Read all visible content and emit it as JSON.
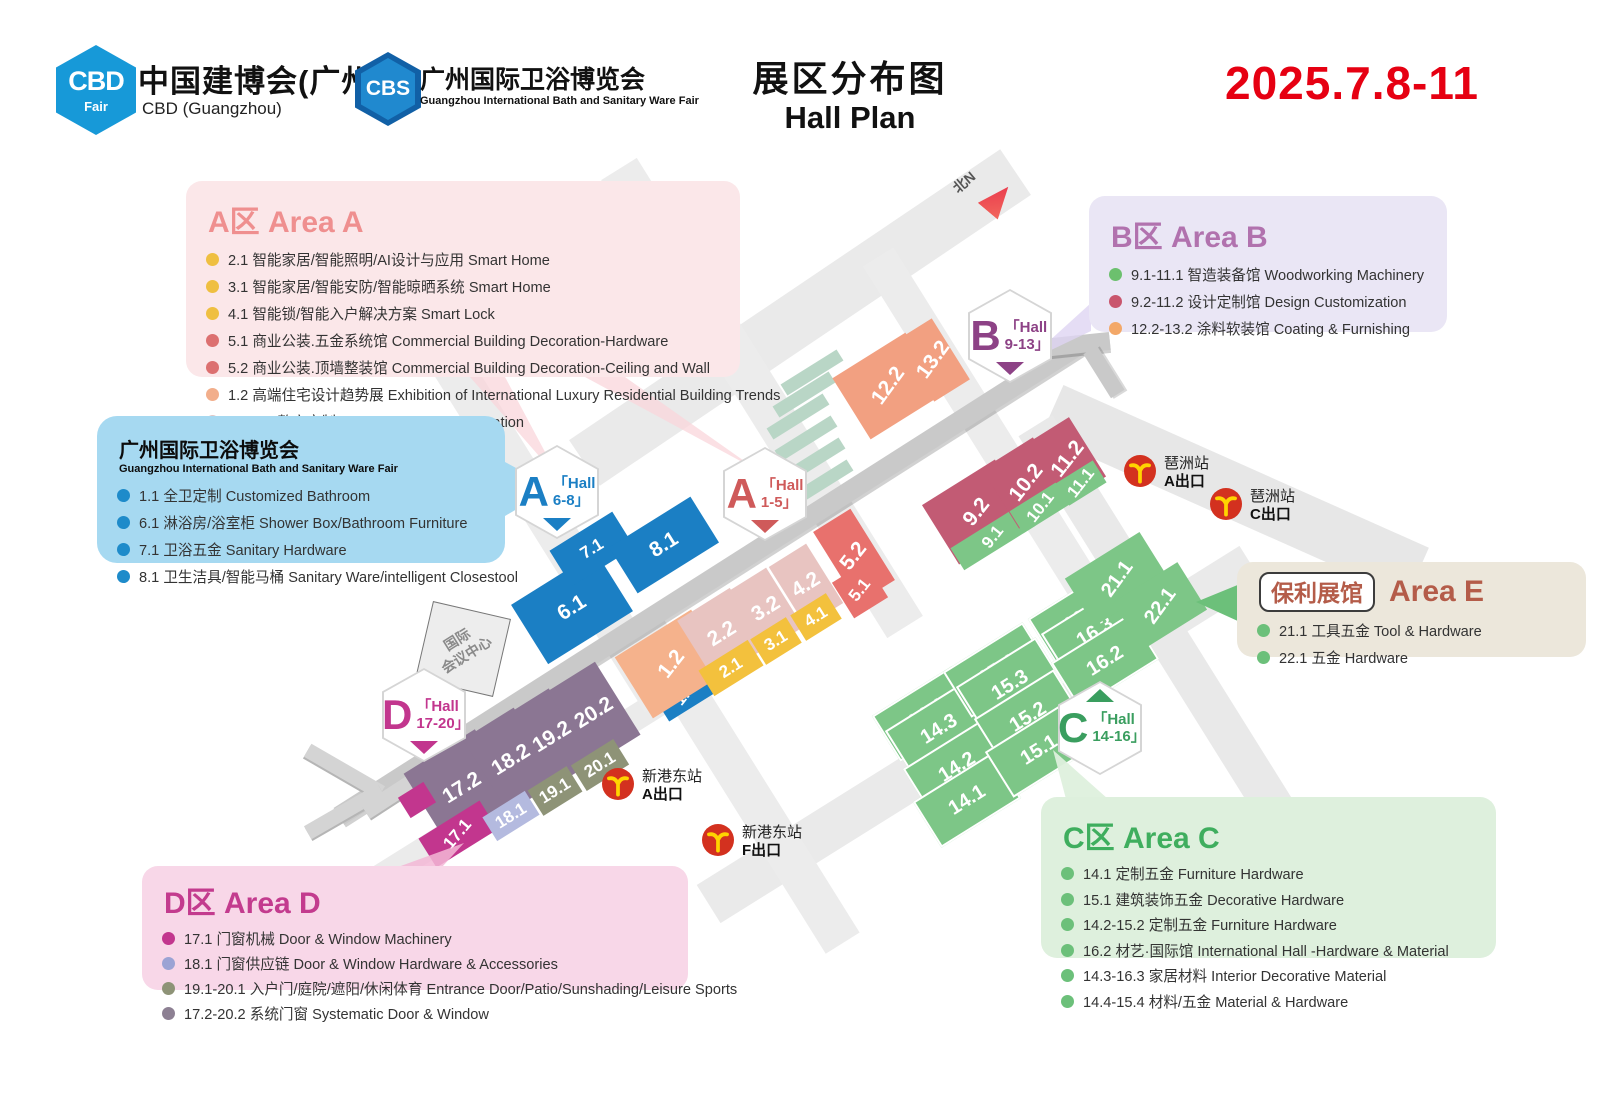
{
  "header": {
    "logo_cbd": {
      "hex": "CBD",
      "hex_sub": "Fair",
      "title": "中国建博会(广州)",
      "subtitle": "CBD (Guangzhou)"
    },
    "logo_cbs": {
      "hex": "CBS",
      "title": "广州国际卫浴博览会",
      "subtitle": "Guangzhou International Bath and Sanitary Ware Fair"
    },
    "title_cn": "展区分布图",
    "title_en": "Hall Plan",
    "date": "2025.7.8-11"
  },
  "legends": {
    "area_a": {
      "title": "A区 Area A",
      "color": "#ef8f8f",
      "bg": "#fbe7e9",
      "items": [
        {
          "dot": "#efbf41",
          "text": "2.1 智能家居/智能照明/AI设计与应用 Smart Home"
        },
        {
          "dot": "#efbf41",
          "text": "3.1 智能家居/智能安防/智能晾晒系统 Smart Home"
        },
        {
          "dot": "#efbf41",
          "text": "4.1 智能锁/智能入户解决方案 Smart Lock"
        },
        {
          "dot": "#dc7070",
          "text": "5.1 商业公装.五金系统馆 Commercial Building Decoration-Hardware"
        },
        {
          "dot": "#dc7070",
          "text": "5.2 商业公装.顶墙整装馆 Commercial Building Decoration-Ceiling and Wall"
        },
        {
          "dot": "#f2ae8b",
          "text": "1.2 高端住宅设计趋势展 Exhibition of International Luxury Residential Building Trends"
        },
        {
          "dot": "#dfc6c6",
          "text": "2.2-4.2 整家定制 Whole House Customization"
        }
      ]
    },
    "bath_fair": {
      "title": "广州国际卫浴博览会",
      "subtitle": "Guangzhou International Bath and Sanitary Ware Fair",
      "bg": "#a6d9f1",
      "items": [
        {
          "dot": "#1e8bca",
          "text": "1.1 全卫定制 Customized Bathroom"
        },
        {
          "dot": "#1e8bca",
          "text": "6.1 淋浴房/浴室柜 Shower Box/Bathroom Furniture"
        },
        {
          "dot": "#1e8bca",
          "text": "7.1 卫浴五金 Sanitary Hardware"
        },
        {
          "dot": "#1e8bca",
          "text": "8.1 卫生洁具/智能马桶 Sanitary Ware/intelligent Closestool"
        }
      ]
    },
    "area_b": {
      "title": "B区 Area B",
      "color": "#b172ae",
      "bg": "#eae6f5",
      "items": [
        {
          "dot": "#6cc06e",
          "text": "9.1-11.1 智造装备馆 Woodworking Machinery"
        },
        {
          "dot": "#c9556d",
          "text": "9.2-11.2 设计定制馆 Design Customization"
        },
        {
          "dot": "#f3a868",
          "text": "12.2-13.2 涂料软装馆 Coating & Furnishing"
        }
      ]
    },
    "area_e": {
      "pill": "保利展馆",
      "title": "Area E",
      "color": "#b45c49",
      "bg": "#ece7db",
      "items": [
        {
          "dot": "#6cc07a",
          "text": "21.1 工具五金 Tool & Hardware"
        },
        {
          "dot": "#6cc07a",
          "text": "22.1 五金 Hardware"
        }
      ]
    },
    "area_c": {
      "title": "C区 Area C",
      "color": "#3fae5e",
      "bg": "#def0dd",
      "items": [
        {
          "dot": "#6cc07a",
          "text": "14.1 定制五金 Furniture Hardware"
        },
        {
          "dot": "#6cc07a",
          "text": "15.1 建筑装饰五金 Decorative Hardware"
        },
        {
          "dot": "#6cc07a",
          "text": "14.2-15.2 定制五金 Furniture Hardware"
        },
        {
          "dot": "#6cc07a",
          "text": "16.2 材艺·国际馆 International Hall -Hardware & Material"
        },
        {
          "dot": "#6cc07a",
          "text": "14.3-16.3 家居材料 Interior Decorative Material"
        },
        {
          "dot": "#6cc07a",
          "text": "14.4-15.4 材料/五金 Material & Hardware"
        }
      ]
    },
    "area_d": {
      "title": "D区 Area D",
      "color": "#c33b8e",
      "bg": "#f8d7e8",
      "items": [
        {
          "dot": "#c2368e",
          "text": "17.1 门窗机械  Door & Window Machinery"
        },
        {
          "dot": "#9ba3d4",
          "text": "18.1 门窗供应链  Door & Window Hardware & Accessories"
        },
        {
          "dot": "#8e9377",
          "text": "19.1-20.1 入户门/庭院/遮阳/休闲体育 Entrance Door/Patio/Sunshading/Leisure Sports"
        },
        {
          "dot": "#8d8093",
          "text": "17.2-20.2 系统门窗 Systematic Door & Window"
        }
      ]
    }
  },
  "map": {
    "north_label": "北N",
    "convention_center_line1": "国际",
    "convention_center_line2": "会议中心",
    "badges": [
      {
        "letter": "A",
        "line1": "「Hall",
        "line2": "6-8」",
        "color": "#1b7fc4",
        "x": 557,
        "y": 492,
        "tri": "bottom"
      },
      {
        "letter": "A",
        "line1": "「Hall",
        "line2": "1-5」",
        "color": "#cf5a5a",
        "x": 765,
        "y": 494,
        "tri": "bottom"
      },
      {
        "letter": "B",
        "line1": "「Hall",
        "line2": "9-13」",
        "color": "#8d4286",
        "x": 1010,
        "y": 336,
        "tri": "bottom"
      },
      {
        "letter": "C",
        "line1": "「Hall",
        "line2": "14-16」",
        "color": "#3a9e5f",
        "x": 1100,
        "y": 728,
        "tri": "top"
      },
      {
        "letter": "D",
        "line1": "「Hall",
        "line2": "17-20」",
        "color": "#c2368e",
        "x": 424,
        "y": 715,
        "tri": "bottom"
      }
    ],
    "stations": [
      {
        "name": "琶洲站",
        "exit": "A出口",
        "x": 1124,
        "y": 455
      },
      {
        "name": "琶洲站",
        "exit": "C出口",
        "x": 1210,
        "y": 488
      },
      {
        "name": "新港东站",
        "exit": "A出口",
        "x": 602,
        "y": 768
      },
      {
        "name": "新港东站",
        "exit": "F出口",
        "x": 702,
        "y": 824
      }
    ],
    "halls": [
      {
        "label": "6.1",
        "x": 572,
        "y": 608,
        "w": 100,
        "h": 70,
        "color": "#1b7fc4",
        "fs": 21
      },
      {
        "label": "7.1",
        "x": 592,
        "y": 549,
        "w": 74,
        "h": 42,
        "color": "#1b7fc4",
        "fs": 17
      },
      {
        "label": "8.1",
        "x": 664,
        "y": 545,
        "w": 96,
        "h": 54,
        "color": "#1b7fc4",
        "fs": 21
      },
      {
        "label": "1.1",
        "x": 685,
        "y": 694,
        "w": 56,
        "h": 30,
        "color": "#1b7fc4",
        "fs": 17,
        "tilt": -20
      },
      {
        "label": "1.2",
        "x": 672,
        "y": 664,
        "w": 90,
        "h": 72,
        "color": "#f5b28c",
        "fs": 21,
        "tilt": -20
      },
      {
        "label": "2.2",
        "x": 722,
        "y": 634,
        "w": 62,
        "h": 70,
        "color": "#e8c4c1",
        "fs": 21
      },
      {
        "label": "3.2",
        "x": 766,
        "y": 609,
        "w": 44,
        "h": 70,
        "color": "#e8c4c1",
        "fs": 21
      },
      {
        "label": "4.2",
        "x": 806,
        "y": 585,
        "w": 44,
        "h": 70,
        "color": "#e8c4c1",
        "fs": 21
      },
      {
        "label": "2.1",
        "x": 731,
        "y": 668,
        "w": 58,
        "h": 30,
        "color": "#f3c13d",
        "fs": 17
      },
      {
        "label": "3.1",
        "x": 776,
        "y": 641,
        "w": 42,
        "h": 30,
        "color": "#f3c13d",
        "fs": 17
      },
      {
        "label": "4.1",
        "x": 816,
        "y": 617,
        "w": 42,
        "h": 30,
        "color": "#f3c13d",
        "fs": 17
      },
      {
        "label": "5.2",
        "x": 854,
        "y": 556,
        "w": 44,
        "h": 84,
        "color": "#e8716d",
        "fs": 21,
        "tilt": -20
      },
      {
        "label": "5.1",
        "x": 860,
        "y": 590,
        "w": 40,
        "h": 42,
        "color": "#e8716d",
        "fs": 17,
        "tilt": -20
      },
      {
        "label": "12.2",
        "x": 888,
        "y": 386,
        "w": 86,
        "h": 72,
        "color": "#f2a081",
        "fs": 21,
        "tilt": -22
      },
      {
        "label": "13.2",
        "x": 933,
        "y": 360,
        "w": 42,
        "h": 72,
        "color": "#f2a081",
        "fs": 21,
        "tilt": -22
      },
      {
        "label": "9.2",
        "x": 977,
        "y": 512,
        "w": 86,
        "h": 70,
        "color": "#c25b74",
        "fs": 21,
        "tilt": -20
      },
      {
        "label": "9.1",
        "x": 993,
        "y": 537,
        "w": 84,
        "h": 26,
        "color": "#7dc687",
        "fs": 17,
        "tilt": -20
      },
      {
        "label": "10.2",
        "x": 1026,
        "y": 483,
        "w": 60,
        "h": 70,
        "color": "#c25b74",
        "fs": 21,
        "tilt": -20
      },
      {
        "label": "10.1",
        "x": 1041,
        "y": 507,
        "w": 58,
        "h": 26,
        "color": "#7dc687",
        "fs": 17,
        "tilt": -20
      },
      {
        "label": "11.2",
        "x": 1068,
        "y": 459,
        "w": 46,
        "h": 70,
        "color": "#c25b74",
        "fs": 21,
        "tilt": -20
      },
      {
        "label": "11.1",
        "x": 1081,
        "y": 483,
        "w": 44,
        "h": 26,
        "color": "#7dc687",
        "fs": 17,
        "tilt": -20
      },
      {
        "label": "14.4",
        "x": 924,
        "y": 712,
        "w": 90,
        "h": 50,
        "color": "#7dc687",
        "fs": 20,
        "outline": true
      },
      {
        "label": "14.3",
        "x": 937,
        "y": 727,
        "w": 90,
        "h": 50,
        "color": "#7dc687",
        "fs": 20,
        "outline": true
      },
      {
        "label": "14.2",
        "x": 955,
        "y": 765,
        "w": 90,
        "h": 50,
        "color": "#7dc687",
        "fs": 20,
        "outline": true
      },
      {
        "label": "14.1",
        "x": 965,
        "y": 798,
        "w": 90,
        "h": 50,
        "color": "#7dc687",
        "fs": 20,
        "outline": true
      },
      {
        "label": "15.4",
        "x": 995,
        "y": 668,
        "w": 90,
        "h": 50,
        "color": "#7dc687",
        "fs": 20,
        "outline": true
      },
      {
        "label": "15.3",
        "x": 1008,
        "y": 683,
        "w": 90,
        "h": 50,
        "color": "#7dc687",
        "fs": 20,
        "outline": true
      },
      {
        "label": "15.2",
        "x": 1026,
        "y": 715,
        "w": 90,
        "h": 50,
        "color": "#7dc687",
        "fs": 20,
        "outline": true
      },
      {
        "label": "15.1",
        "x": 1037,
        "y": 748,
        "w": 90,
        "h": 50,
        "color": "#7dc687",
        "fs": 20,
        "outline": true
      },
      {
        "label": "16.4",
        "x": 1080,
        "y": 615,
        "w": 90,
        "h": 50,
        "color": "#7dc687",
        "fs": 20,
        "outline": true
      },
      {
        "label": "16.3",
        "x": 1093,
        "y": 630,
        "w": 90,
        "h": 50,
        "color": "#7dc687",
        "fs": 20,
        "outline": true
      },
      {
        "label": "16.2",
        "x": 1103,
        "y": 659,
        "w": 90,
        "h": 50,
        "color": "#7dc687",
        "fs": 20,
        "outline": true
      },
      {
        "label": "21.1",
        "x": 1117,
        "y": 579,
        "w": 88,
        "h": 56,
        "color": "#7dc687",
        "fs": 20,
        "tilt": -22
      },
      {
        "label": "22.1",
        "x": 1160,
        "y": 606,
        "w": 76,
        "h": 56,
        "color": "#7dc687",
        "fs": 20,
        "tilt": -22
      },
      {
        "label": "17.2",
        "x": 462,
        "y": 788,
        "w": 84,
        "h": 86,
        "color": "#8b7693",
        "fs": 21
      },
      {
        "label": "18.2",
        "x": 511,
        "y": 760,
        "w": 60,
        "h": 86,
        "color": "#8b7693",
        "fs": 21
      },
      {
        "label": "19.2",
        "x": 552,
        "y": 737,
        "w": 46,
        "h": 86,
        "color": "#8b7693",
        "fs": 21
      },
      {
        "label": "20.2",
        "x": 594,
        "y": 713,
        "w": 56,
        "h": 86,
        "color": "#8b7693",
        "fs": 21
      },
      {
        "label": "",
        "x": 417,
        "y": 800,
        "w": 30,
        "h": 24,
        "color": "#c2368e",
        "fs": 14
      },
      {
        "label": "17.1",
        "x": 458,
        "y": 834,
        "w": 72,
        "h": 34,
        "color": "#c2368e",
        "fs": 17,
        "tilt": -18
      },
      {
        "label": "18.1",
        "x": 511,
        "y": 816,
        "w": 50,
        "h": 28,
        "color": "#b4badf",
        "fs": 17
      },
      {
        "label": "19.1",
        "x": 555,
        "y": 791,
        "w": 46,
        "h": 30,
        "color": "#8e9377",
        "fs": 17
      },
      {
        "label": "20.1",
        "x": 600,
        "y": 765,
        "w": 50,
        "h": 30,
        "color": "#8e9377",
        "fs": 17
      }
    ]
  }
}
